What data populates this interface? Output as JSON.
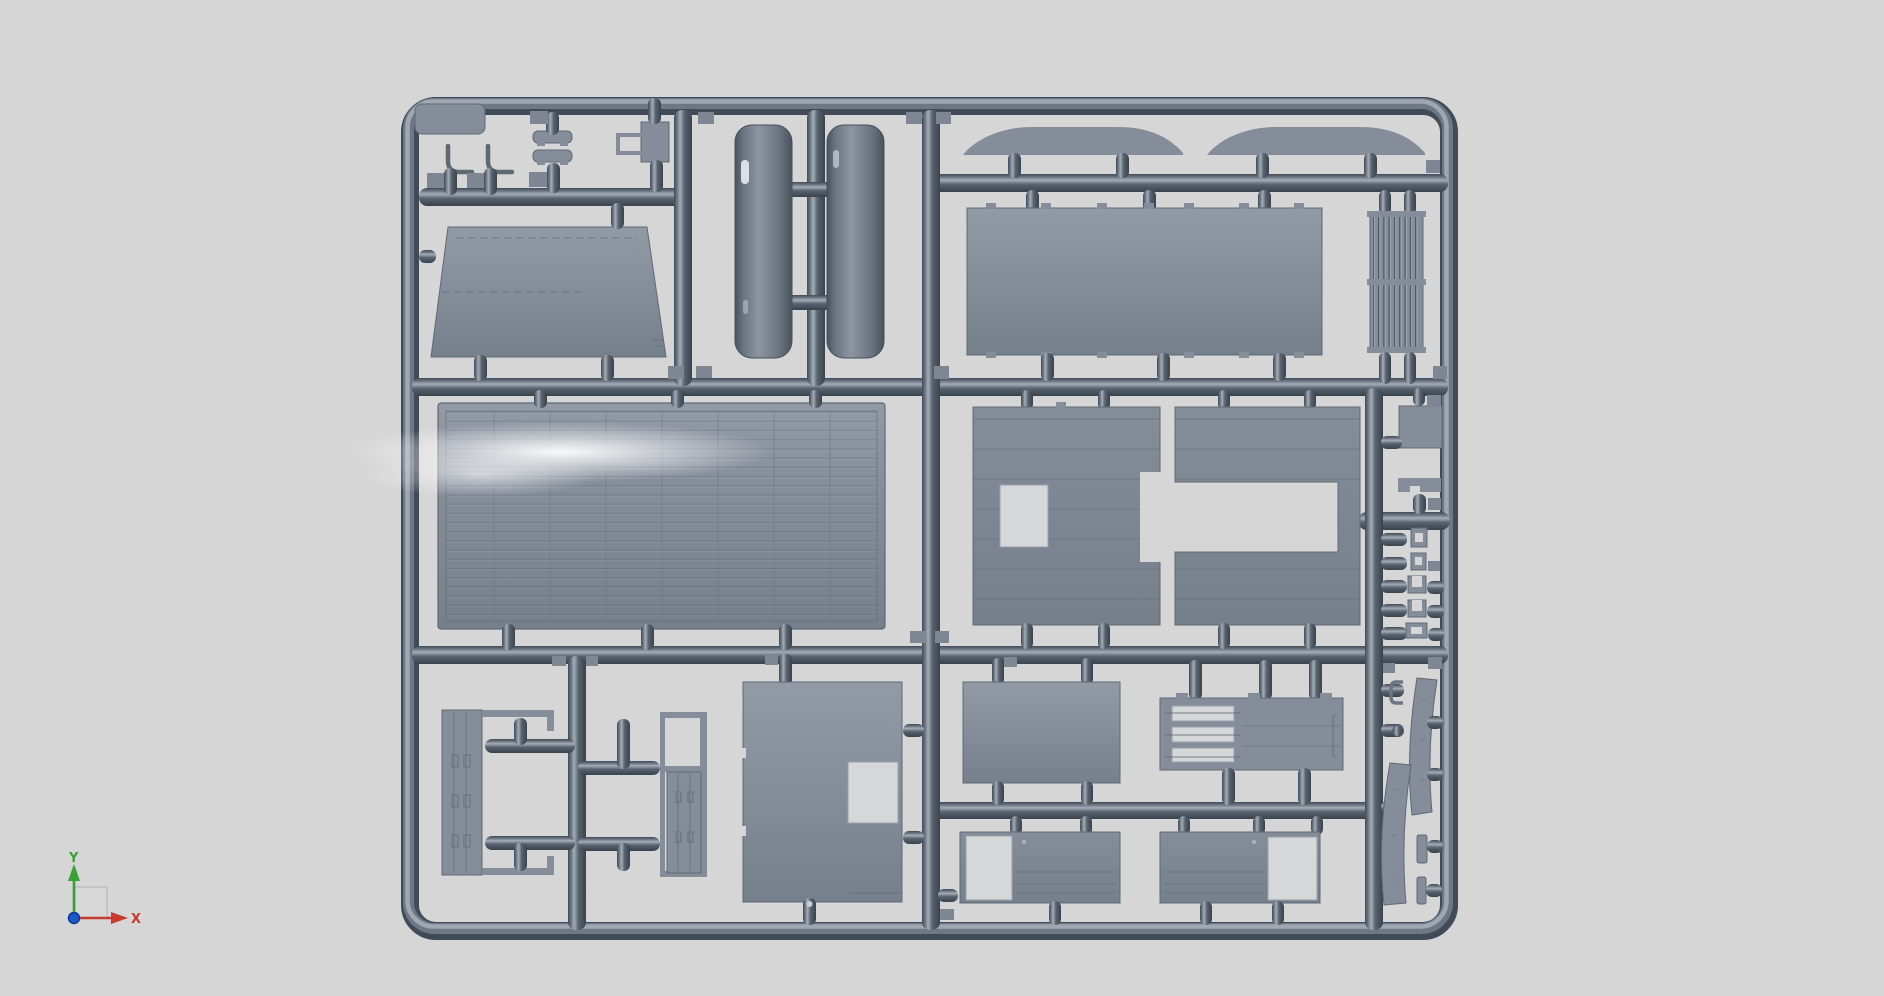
{
  "viewport": {
    "kind": "3d-cad-viewport",
    "content": "injection-molded model kit sprue render"
  },
  "axis_gizmo": {
    "x_label": "X",
    "y_label": "Y"
  },
  "colors": {
    "background": "#d6d6d7",
    "tube_dark": "#414b57",
    "tube_dark2": "#39434e",
    "tube_mid": "#6e7884",
    "tube_mid2": "#59636f",
    "tube_hi": "#a4adb7",
    "part_gray": "#848d99",
    "part_lite": "#929aa6",
    "part_mid": "#76808c",
    "part_edge": "#5f6974",
    "panel_light": "#d6d7d8",
    "cut_edge": "#9aa2ac",
    "gate_gray": "#7d8692",
    "fender_dark": "#49535e",
    "fender_mid": "#6a7480",
    "fender_lite": "#8d96a1",
    "fender_edge": "#46505b",
    "spec_white": "#ffffff",
    "axis_x_red": "#c8392e",
    "axis_y_green": "#3aa038",
    "origin_blue": "#1a57c8",
    "origin_blue_dark": "#0d3a96",
    "gizmo_fill": "#d9d9da",
    "gizmo_stroke": "#b5b6b8"
  }
}
